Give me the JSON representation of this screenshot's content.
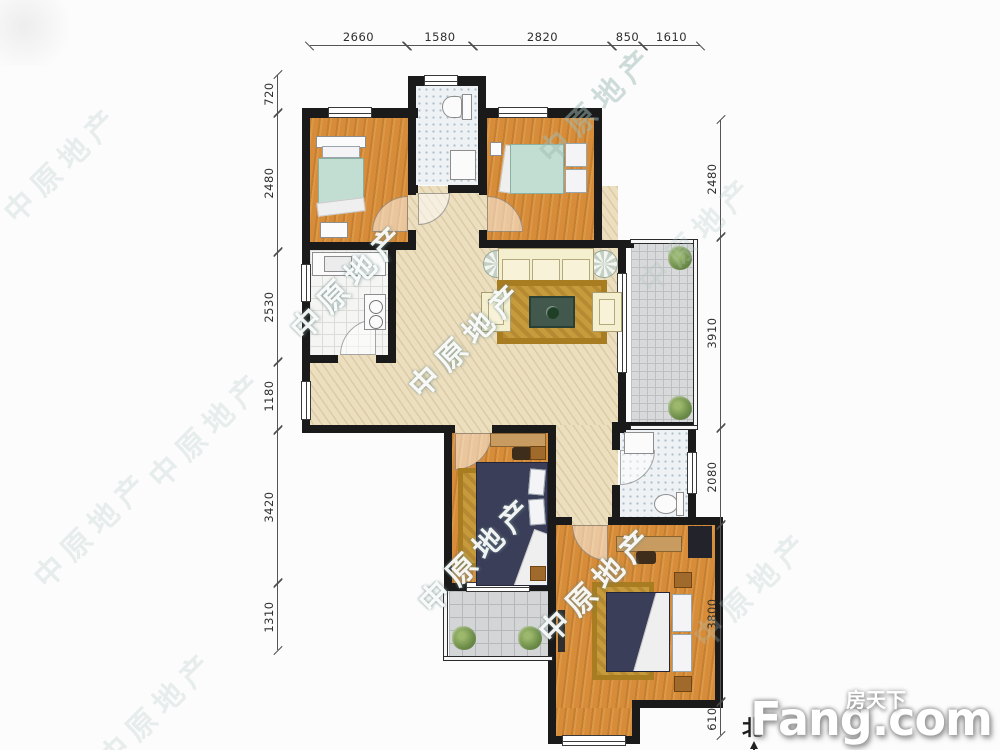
{
  "plan": {
    "watermark_text": "中原地产",
    "north_label": "北"
  },
  "dimensions": {
    "top": [
      "2660",
      "1580",
      "2820",
      "850",
      "1610"
    ],
    "left": [
      "720",
      "2480",
      "2530",
      "1180",
      "3420",
      "1310"
    ],
    "right": [
      "2480",
      "3910",
      "2080",
      "3800",
      "610"
    ]
  },
  "logo": {
    "brand": "Fang.com",
    "brand_cn": "房天下"
  }
}
